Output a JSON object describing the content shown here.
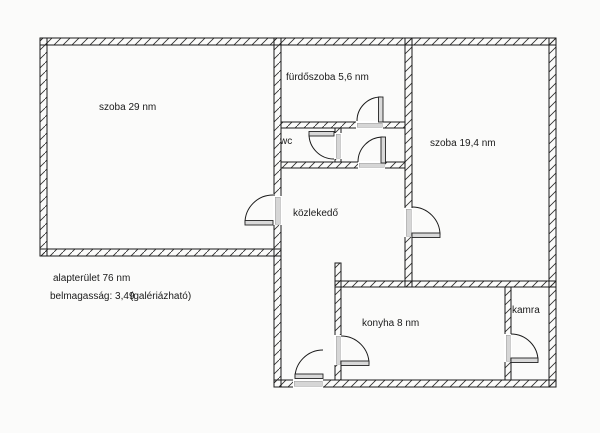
{
  "colors": {
    "wall": "#1a1a1a",
    "door_jamb": "#d6d6d6",
    "door_leaf": "#d9d9d9",
    "text": "#1a1a1a",
    "background": "#fbfbfa"
  },
  "floor_plan": {
    "rooms": [
      {
        "name": "szoba29",
        "label": "szoba 29 nm"
      },
      {
        "name": "furdoszoba",
        "label": "fürdőszoba 5,6 nm"
      },
      {
        "name": "wc",
        "label": "wc"
      },
      {
        "name": "szoba194",
        "label": "szoba 19,4 nm"
      },
      {
        "name": "kozlekedo",
        "label": "közlekedő"
      },
      {
        "name": "konyha",
        "label": "konyha 8 nm"
      },
      {
        "name": "kamra",
        "label": "kamra"
      }
    ],
    "annotations": {
      "total_area": "alapterület 76 nm",
      "ceiling_height": "belmagasság: 3,49",
      "note": "(galériázható)"
    }
  }
}
